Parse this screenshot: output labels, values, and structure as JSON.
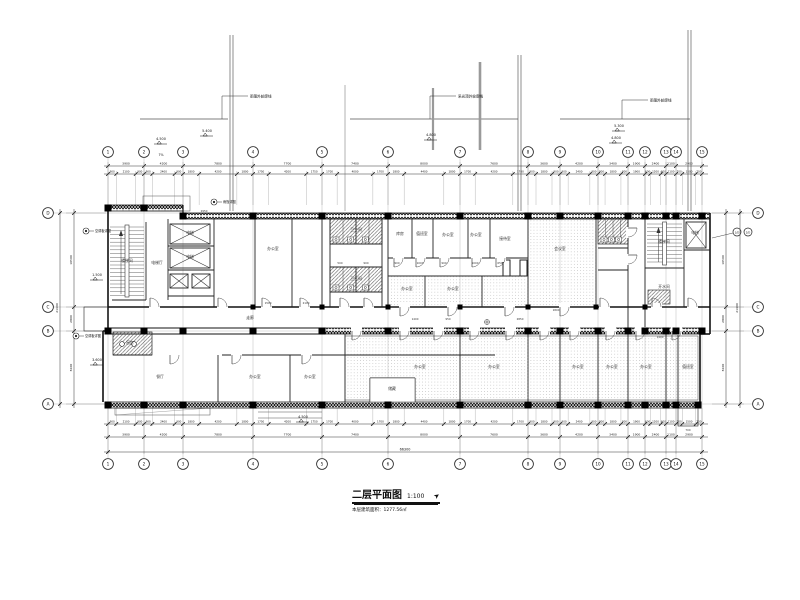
{
  "drawing": {
    "title": "二层平面图",
    "scale": "1:100",
    "subtitle_label": "本层建筑面积",
    "area": "1277.56㎡"
  },
  "icons": {
    "north_arrow": "➤"
  },
  "axes": {
    "vertical_labels": [
      "1",
      "2",
      "3",
      "4",
      "5",
      "6",
      "7",
      "8",
      "9",
      "10",
      "11",
      "12",
      "13",
      "14",
      "15"
    ],
    "horizontal_labels": [
      "A",
      "B",
      "C",
      "D"
    ],
    "sub_labels": [
      "1/D",
      "2/D"
    ]
  },
  "dims": {
    "overall": "66300",
    "top_major": [
      "3900",
      "4200",
      "7800",
      "7700",
      "7400",
      "8000",
      "7600",
      "3600",
      "4200",
      "3400",
      "1900",
      "2400",
      "1100",
      "2900"
    ],
    "top_minor": [
      [
        "900",
        "2100",
        "900"
      ],
      [
        "900",
        "2400",
        "900"
      ],
      [
        "1800",
        "4200",
        "1800"
      ],
      [
        "1750",
        "4200",
        "1750"
      ],
      [
        "1700",
        "4000",
        "1700"
      ],
      [
        "1800",
        "4400",
        "1800"
      ],
      [
        "1700",
        "4200",
        "1700"
      ],
      [
        "900",
        "1800",
        "900"
      ],
      [
        "900",
        "2400",
        "900"
      ],
      [
        "800",
        "1800",
        "800"
      ],
      [
        "1900"
      ],
      [
        "600",
        "1200",
        "600"
      ],
      [
        "1100"
      ],
      [
        "700",
        "1500",
        "700"
      ]
    ],
    "bottom_major": [
      "3900",
      "4200",
      "7800",
      "7700",
      "7400",
      "8000",
      "7600",
      "3600",
      "4200",
      "3400",
      "1900",
      "2400",
      "1100",
      "2900"
    ],
    "bottom_minor": [
      [
        "900",
        "2100",
        "900"
      ],
      [
        "900",
        "2400",
        "900"
      ],
      [
        "1800",
        "4200",
        "1800"
      ],
      [
        "1750",
        "4200",
        "1750"
      ],
      [
        "1700",
        "4000",
        "1700"
      ],
      [
        "1800",
        "4400",
        "1800"
      ],
      [
        "1700",
        "4200",
        "1700"
      ],
      [
        "900",
        "1800",
        "900"
      ],
      [
        "900",
        "2400",
        "900"
      ],
      [
        "800",
        "1800",
        "800"
      ],
      [
        "1900"
      ],
      [
        "600",
        "1200",
        "600"
      ],
      [
        "1100"
      ],
      [
        "700",
        "1500",
        "700"
      ]
    ],
    "left_segments": [
      "8100",
      "2800",
      "10500"
    ],
    "left_total": "21400",
    "right_segments": [
      "8100",
      "2800",
      "10500"
    ],
    "right_total": "21400"
  },
  "elevations": [
    "4.500",
    "5.400",
    "4.800",
    "5.300",
    "4.800",
    "4.500",
    "1.500",
    "3.600"
  ],
  "slope_note": "7%",
  "leader_notes": [
    "雨篷外轮廓线",
    "采光顶外轮廓线",
    "雨篷外轮廓线"
  ],
  "detail_notes": [
    "空调板详图",
    "空调板详图",
    "雨篷详图"
  ],
  "interior_dims": [
    "2950",
    "1500",
    "2100",
    "900",
    "1000",
    "900",
    "1000",
    "650",
    "1400",
    "950",
    "2850",
    "1800",
    "1400",
    "700",
    "500",
    "900"
  ],
  "room_labels": [
    "楼梯间",
    "电梯",
    "电梯",
    "电梯厅",
    "办公室",
    "卫生间",
    "卫生间",
    "库房",
    "值班室",
    "办公室",
    "办公室",
    "会议室",
    "办公室",
    "办公室",
    "走廊",
    "楼梯间",
    "电梯",
    "开水间",
    "厨房",
    "餐厅",
    "办公室",
    "办公室",
    "办公室",
    "办公室",
    "办公室",
    "办公室",
    "办公室",
    "值班室",
    "接待室",
    "储藏"
  ]
}
